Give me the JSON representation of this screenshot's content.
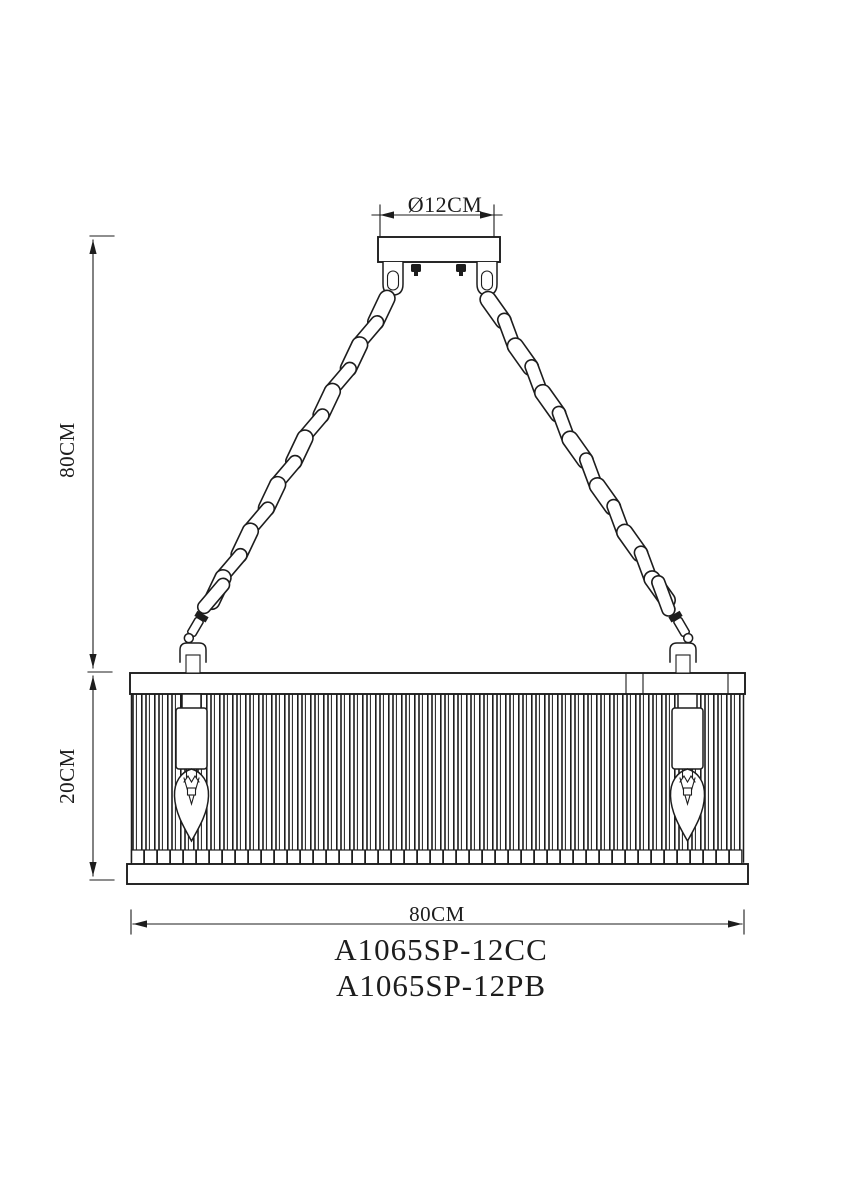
{
  "drawing": {
    "dimension_labels": {
      "canopy_diameter": "Ø12CM",
      "hang_height": "80CM",
      "shade_height": "20CM",
      "shade_width": "80CM"
    },
    "model_numbers": [
      "A1065SP-12CC",
      "A1065SP-12PB"
    ],
    "colors": {
      "line": "#1d1d1d",
      "background": "#ffffff"
    }
  }
}
